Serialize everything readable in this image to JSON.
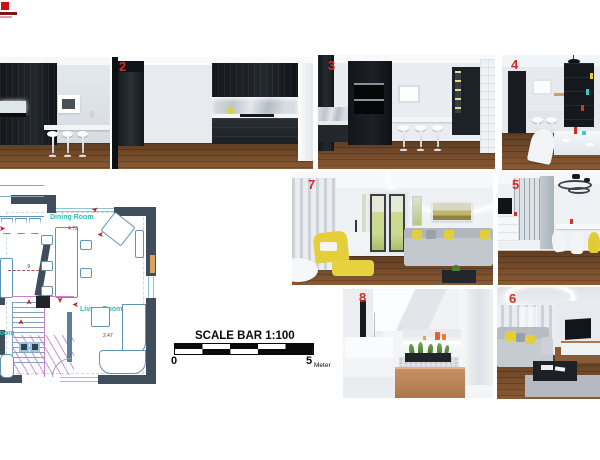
{
  "colors": {
    "marker_red": "#d62b22",
    "plan_wall": "#3f4e5a",
    "plan_furniture_line": "#5f93b8",
    "plan_label_teal": "#2fbdb3",
    "plan_dimension_red": "#8c1a1a",
    "stairs_pink": "#cc7fcc",
    "wood_floor": "#7a5231",
    "accent_yellow": "#e4cf3a"
  },
  "icons": {
    "camera_arrow": "➤"
  },
  "render_numbers": {
    "n2": "2",
    "n3": "3",
    "n4": "4",
    "n5": "5",
    "n6": "6",
    "n7": "7",
    "n8": "8"
  },
  "floor_plan": {
    "room_labels": {
      "dining": "Dining Room",
      "living": "Living Room",
      "partial": "room"
    },
    "dimensions": {
      "dining_width": "4.73",
      "living_width": "2.47",
      "table_offset": ".9"
    }
  },
  "scale_bar": {
    "title": "SCALE BAR 1:100",
    "start": "0",
    "end": "5",
    "unit": "Meter"
  }
}
